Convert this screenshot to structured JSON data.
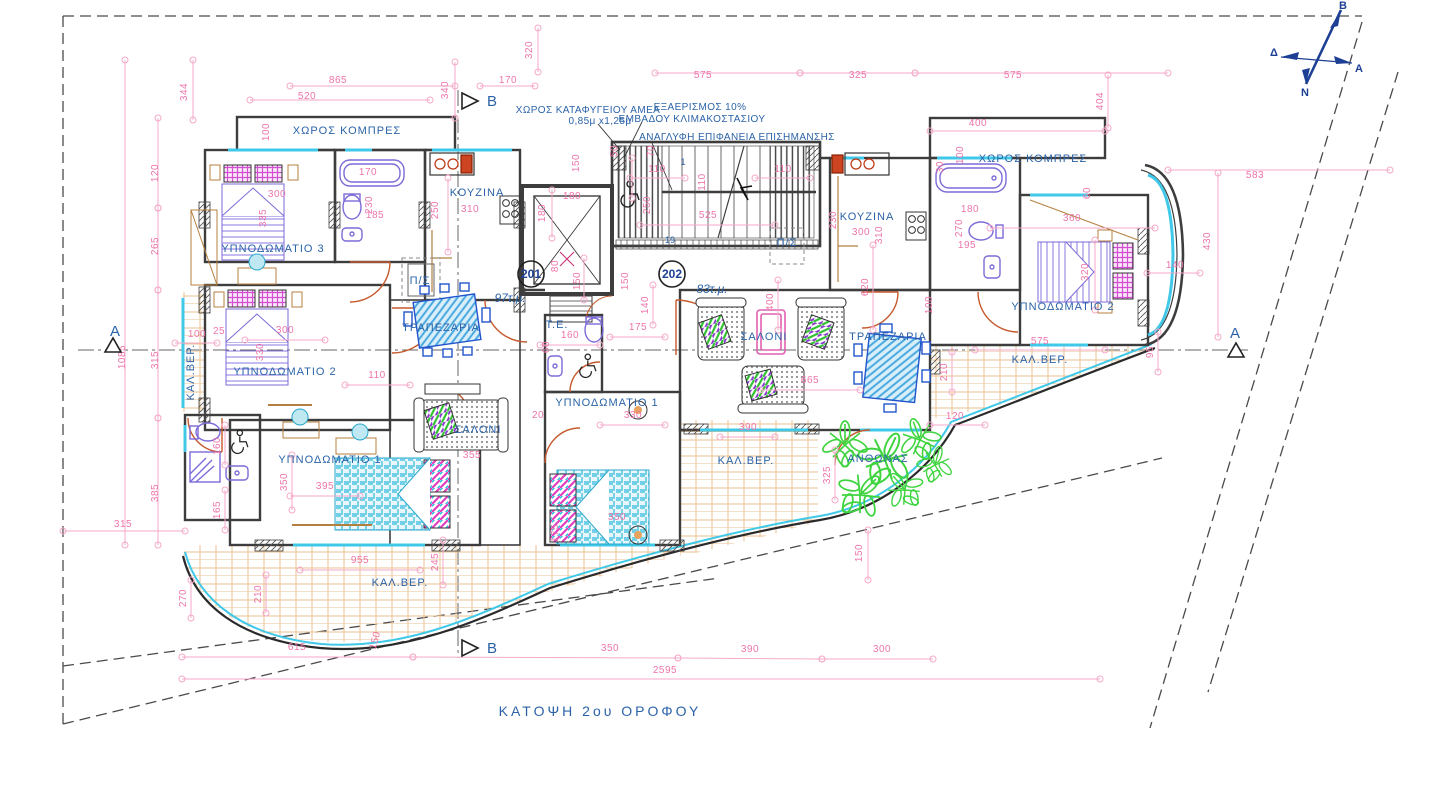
{
  "title": "ΚΑΤΟΨΗ   2ου   ΟΡΟΦΟΥ",
  "colors": {
    "dimension_pink": "#ee74ab",
    "label_blue": "#2b63a8",
    "navy": "#1d3f94",
    "wall_gray": "#3d3d3d",
    "window_cyan": "#3fc8e8",
    "tile_tan": "#eac291",
    "door_orange": "#c65a2e",
    "fixture_purple": "#7d6ad8",
    "table_blue": "#4aa8e0",
    "plant_green": "#3fd43f",
    "pillow_magenta": "#d24fd2"
  },
  "north": {
    "n": "Β",
    "w": "Δ",
    "e": "Α",
    "s": "Ν"
  },
  "section_markers": [
    {
      "label": "B",
      "x": 487,
      "y": 104
    },
    {
      "label": "B",
      "x": 487,
      "y": 651
    },
    {
      "label": "A",
      "x": 117,
      "y": 332
    },
    {
      "label": "A",
      "x": 1236,
      "y": 332
    }
  ],
  "apartments": [
    {
      "number": "201",
      "x": 531,
      "y": 274,
      "area": "97τ.μ.",
      "ax": 510,
      "ay": 302
    },
    {
      "number": "202",
      "x": 672,
      "y": 274,
      "area": "83τ.μ.",
      "ax": 712,
      "ay": 293
    }
  ],
  "stair_numbers": [
    {
      "t": "1",
      "x": 683,
      "y": 165
    },
    {
      "t": "19",
      "x": 670,
      "y": 243
    }
  ],
  "notes": {
    "refuge_1": "ΧΩΡΟΣ ΚΑΤΑΦΥΓΕΙΟΥ ΑΜΕΑ",
    "refuge_2": "0,85μ x1,25μ",
    "vent_1": "ΕΞΑΕΡΙΣΜΟΣ 10%",
    "vent_2": "ΕΜΒΑΔΟΥ ΚΛΙΜΑΚΟΣΤΑΣΙΟΥ",
    "relief": "ΑΝΑΓΛΥΦΗ ΕΠΙΦΑΝΕΙΑ ΕΠΙΣΗΜΑΝΣΗΣ"
  },
  "room_labels": [
    {
      "t": "ΧΩΡΟΣ ΚΟΜΠΡΕΣ",
      "x": 347,
      "y": 134
    },
    {
      "t": "ΧΩΡΟΣ ΚΟΜΠΡΕΣ",
      "x": 1033,
      "y": 162
    },
    {
      "t": "ΥΠΝΟΔΩΜΑΤΙΟ 3",
      "x": 273,
      "y": 252
    },
    {
      "t": "ΥΠΝΟΔΩΜΑΤΙΟ 2",
      "x": 285,
      "y": 375
    },
    {
      "t": "ΥΠΝΟΔΩΜΑΤΙΟ 1",
      "x": 330,
      "y": 463
    },
    {
      "t": "ΥΠΝΟΔΩΜΑΤΙΟ 1",
      "x": 607,
      "y": 406
    },
    {
      "t": "ΥΠΝΟΔΩΜΑΤΙΟ 2",
      "x": 1063,
      "y": 310
    },
    {
      "t": "ΚΟΥΖΙΝΑ",
      "x": 477,
      "y": 196
    },
    {
      "t": "ΚΟΥΖΙΝΑ",
      "x": 867,
      "y": 220
    },
    {
      "t": "ΣΑΛΟΝΙ",
      "x": 478,
      "y": 433
    },
    {
      "t": "ΣΑΛΟΝΙ",
      "x": 764,
      "y": 340
    },
    {
      "t": "ΤΡΑΠΕΖΑΡΙΑ",
      "x": 441,
      "y": 331
    },
    {
      "t": "ΤΡΑΠΕΖΑΡΙΑ",
      "x": 888,
      "y": 340
    },
    {
      "t": "ΚΑΛ.ΒΕΡ.",
      "x": 400,
      "y": 586
    },
    {
      "t": "ΚΑΛ.ΒΕΡ.",
      "x": 746,
      "y": 464
    },
    {
      "t": "ΚΑΛ.ΒΕΡ.",
      "x": 1040,
      "y": 363
    },
    {
      "t": "ΚΑΛ.ΒΕΡ.",
      "x": 194,
      "y": 372,
      "r": -90
    },
    {
      "t": "ΑΝΘΩΝΑΣ",
      "x": 878,
      "y": 462
    },
    {
      "t": "Τ.Ε.",
      "x": 557,
      "y": 328
    },
    {
      "t": "Π/Σ",
      "x": 420,
      "y": 284
    },
    {
      "t": "Π/Σ",
      "x": 787,
      "y": 246
    }
  ],
  "dimensions": [
    {
      "t": "344",
      "x": 187,
      "y": 92,
      "r": -90
    },
    {
      "t": "865",
      "x": 338,
      "y": 83
    },
    {
      "t": "520",
      "x": 307,
      "y": 99
    },
    {
      "t": "340",
      "x": 448,
      "y": 90,
      "r": -90
    },
    {
      "t": "170",
      "x": 508,
      "y": 83
    },
    {
      "t": "320",
      "x": 532,
      "y": 50,
      "r": -90
    },
    {
      "t": "575",
      "x": 703,
      "y": 78
    },
    {
      "t": "325",
      "x": 858,
      "y": 78
    },
    {
      "t": "575",
      "x": 1013,
      "y": 78
    },
    {
      "t": "404",
      "x": 1103,
      "y": 101,
      "r": -90
    },
    {
      "t": "400",
      "x": 978,
      "y": 126
    },
    {
      "t": "583",
      "x": 1255,
      "y": 178
    },
    {
      "t": "430",
      "x": 1210,
      "y": 241,
      "r": -90
    },
    {
      "t": "140",
      "x": 1175,
      "y": 268
    },
    {
      "t": "95",
      "x": 1153,
      "y": 352,
      "r": -90
    },
    {
      "t": "120",
      "x": 158,
      "y": 173,
      "r": -90
    },
    {
      "t": "265",
      "x": 158,
      "y": 246,
      "r": -90
    },
    {
      "t": "315",
      "x": 158,
      "y": 360,
      "r": -90
    },
    {
      "t": "385",
      "x": 158,
      "y": 493,
      "r": -90
    },
    {
      "t": "1085",
      "x": 125,
      "y": 357,
      "r": -90
    },
    {
      "t": "315",
      "x": 123,
      "y": 527
    },
    {
      "t": "100",
      "x": 197,
      "y": 337
    },
    {
      "t": "25",
      "x": 219,
      "y": 334
    },
    {
      "t": "300",
      "x": 285,
      "y": 333
    },
    {
      "t": "330",
      "x": 263,
      "y": 352,
      "r": -90
    },
    {
      "t": "110",
      "x": 377,
      "y": 378
    },
    {
      "t": "160",
      "x": 220,
      "y": 446,
      "r": -90
    },
    {
      "t": "165",
      "x": 220,
      "y": 510,
      "r": -90
    },
    {
      "t": "955",
      "x": 360,
      "y": 563
    },
    {
      "t": "245",
      "x": 438,
      "y": 562,
      "r": -90
    },
    {
      "t": "210",
      "x": 261,
      "y": 594,
      "r": -90
    },
    {
      "t": "270",
      "x": 186,
      "y": 598,
      "r": -90
    },
    {
      "t": "350",
      "x": 287,
      "y": 482,
      "r": -90
    },
    {
      "t": "395",
      "x": 325,
      "y": 489
    },
    {
      "t": "615",
      "x": 297,
      "y": 650
    },
    {
      "t": "150",
      "x": 378,
      "y": 641,
      "r": -75
    },
    {
      "t": "350",
      "x": 610,
      "y": 651
    },
    {
      "t": "390",
      "x": 750,
      "y": 652
    },
    {
      "t": "300",
      "x": 882,
      "y": 652
    },
    {
      "t": "2595",
      "x": 665,
      "y": 673
    },
    {
      "t": "100",
      "x": 269,
      "y": 132,
      "r": -90
    },
    {
      "t": "300",
      "x": 277,
      "y": 197
    },
    {
      "t": "335",
      "x": 266,
      "y": 218,
      "r": -90
    },
    {
      "t": "170",
      "x": 368,
      "y": 175
    },
    {
      "t": "230",
      "x": 372,
      "y": 205,
      "r": -90
    },
    {
      "t": "185",
      "x": 375,
      "y": 218
    },
    {
      "t": "250",
      "x": 438,
      "y": 210,
      "r": -90
    },
    {
      "t": "310",
      "x": 470,
      "y": 212
    },
    {
      "t": "180",
      "x": 545,
      "y": 213,
      "r": -90
    },
    {
      "t": "180",
      "x": 572,
      "y": 199
    },
    {
      "t": "150",
      "x": 579,
      "y": 163,
      "r": -90
    },
    {
      "t": "70",
      "x": 654,
      "y": 151,
      "r": -90
    },
    {
      "t": "50",
      "x": 617,
      "y": 151,
      "r": -90
    },
    {
      "t": "110",
      "x": 657,
      "y": 172
    },
    {
      "t": "110",
      "x": 783,
      "y": 172
    },
    {
      "t": "110",
      "x": 705,
      "y": 182,
      "r": -90
    },
    {
      "t": "250",
      "x": 650,
      "y": 205,
      "r": -90
    },
    {
      "t": "525",
      "x": 708,
      "y": 218
    },
    {
      "t": "150",
      "x": 580,
      "y": 281,
      "r": -90
    },
    {
      "t": "150",
      "x": 628,
      "y": 281,
      "r": -90
    },
    {
      "t": "80",
      "x": 558,
      "y": 266,
      "r": -90
    },
    {
      "t": "160",
      "x": 570,
      "y": 338
    },
    {
      "t": "60",
      "x": 549,
      "y": 347,
      "r": -90
    },
    {
      "t": "175",
      "x": 638,
      "y": 330
    },
    {
      "t": "140",
      "x": 648,
      "y": 305,
      "r": -90
    },
    {
      "t": "330",
      "x": 633,
      "y": 418
    },
    {
      "t": "20",
      "x": 538,
      "y": 418
    },
    {
      "t": "355",
      "x": 472,
      "y": 458
    },
    {
      "t": "350",
      "x": 617,
      "y": 520
    },
    {
      "t": "175",
      "x": 558,
      "y": 533,
      "r": -90
    },
    {
      "t": "400",
      "x": 773,
      "y": 302,
      "r": -90
    },
    {
      "t": "620",
      "x": 868,
      "y": 287,
      "r": -90
    },
    {
      "t": "665",
      "x": 810,
      "y": 383
    },
    {
      "t": "100",
      "x": 932,
      "y": 305,
      "r": -90
    },
    {
      "t": "390",
      "x": 748,
      "y": 430
    },
    {
      "t": "120",
      "x": 955,
      "y": 419
    },
    {
      "t": "210",
      "x": 947,
      "y": 372,
      "r": -90
    },
    {
      "t": "325",
      "x": 830,
      "y": 475,
      "r": -90
    },
    {
      "t": "575",
      "x": 1040,
      "y": 344
    },
    {
      "t": "150",
      "x": 862,
      "y": 553,
      "r": -90
    },
    {
      "t": "230",
      "x": 836,
      "y": 220,
      "r": -90
    },
    {
      "t": "300",
      "x": 861,
      "y": 235
    },
    {
      "t": "310",
      "x": 882,
      "y": 235,
      "r": -90
    },
    {
      "t": "100",
      "x": 963,
      "y": 155,
      "r": -90
    },
    {
      "t": "30",
      "x": 943,
      "y": 167,
      "r": -90
    },
    {
      "t": "180",
      "x": 970,
      "y": 212
    },
    {
      "t": "270",
      "x": 962,
      "y": 228,
      "r": -90
    },
    {
      "t": "195",
      "x": 967,
      "y": 248
    },
    {
      "t": "360",
      "x": 1072,
      "y": 221
    },
    {
      "t": "320",
      "x": 1088,
      "y": 272,
      "r": -90
    },
    {
      "t": "60",
      "x": 1090,
      "y": 193,
      "r": -90
    }
  ]
}
